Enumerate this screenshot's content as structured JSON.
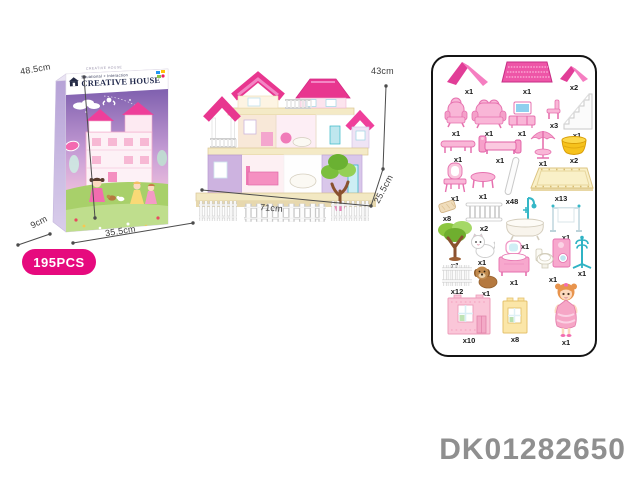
{
  "product_code": "DK01282650",
  "pieces_badge": "195PCS",
  "box": {
    "top_text": "CREATIVE HOUSE",
    "subtitle": "Situational + Interaction",
    "title": "CREATIVE HOUSE",
    "height_label": "48.5cm",
    "depth_label": "9cm",
    "width_label": "35.5cm"
  },
  "house": {
    "height_label": "43cm",
    "width_label": "71cm",
    "depth_label": "25.5cm"
  },
  "parts_panel": {
    "items": [
      {
        "name": "large-gable-roof",
        "qty": "x1"
      },
      {
        "name": "roof-panel",
        "qty": "x1"
      },
      {
        "name": "small-gable-roof",
        "qty": "x2"
      },
      {
        "name": "armchair",
        "qty": "x1"
      },
      {
        "name": "sofa",
        "qty": "x1"
      },
      {
        "name": "tv-cabinet",
        "qty": "x1"
      },
      {
        "name": "chair",
        "qty": "x3"
      },
      {
        "name": "staircase",
        "qty": "x1"
      },
      {
        "name": "long-table",
        "qty": "x1"
      },
      {
        "name": "bed",
        "qty": "x1"
      },
      {
        "name": "parasol-table",
        "qty": "x1"
      },
      {
        "name": "basket",
        "qty": "x2"
      },
      {
        "name": "dressing-table",
        "qty": "x1"
      },
      {
        "name": "round-table",
        "qty": "x1"
      },
      {
        "name": "pillar",
        "qty": "x48"
      },
      {
        "name": "floor-panel",
        "qty": "x13"
      },
      {
        "name": "cushion",
        "qty": "x8"
      },
      {
        "name": "railing",
        "qty": "x2"
      },
      {
        "name": "bathtub-shower",
        "qty": "x1"
      },
      {
        "name": "towel-rack",
        "qty": "x1"
      },
      {
        "name": "tree",
        "qty": "x1"
      },
      {
        "name": "cat",
        "qty": "x1"
      },
      {
        "name": "wash-basin",
        "qty": "x1"
      },
      {
        "name": "toilet-washer",
        "qty": "x1"
      },
      {
        "name": "coat-rack",
        "qty": "x1"
      },
      {
        "name": "picket-fence",
        "qty": "x12"
      },
      {
        "name": "dog",
        "qty": "x1"
      },
      {
        "name": "pink-wall-panel",
        "qty": "x10"
      },
      {
        "name": "yellow-wall-panel",
        "qty": "x8"
      },
      {
        "name": "doll",
        "qty": "x1"
      }
    ]
  },
  "colors": {
    "badge_pink": "#e60a7e",
    "roof_pink": "#e8368f",
    "furniture_pink": "#f6a8cd",
    "teal": "#35b7c7",
    "basket_yellow": "#f6c21c",
    "floor_cream": "#f7efc8",
    "code_gray": "#8f8f8f"
  }
}
